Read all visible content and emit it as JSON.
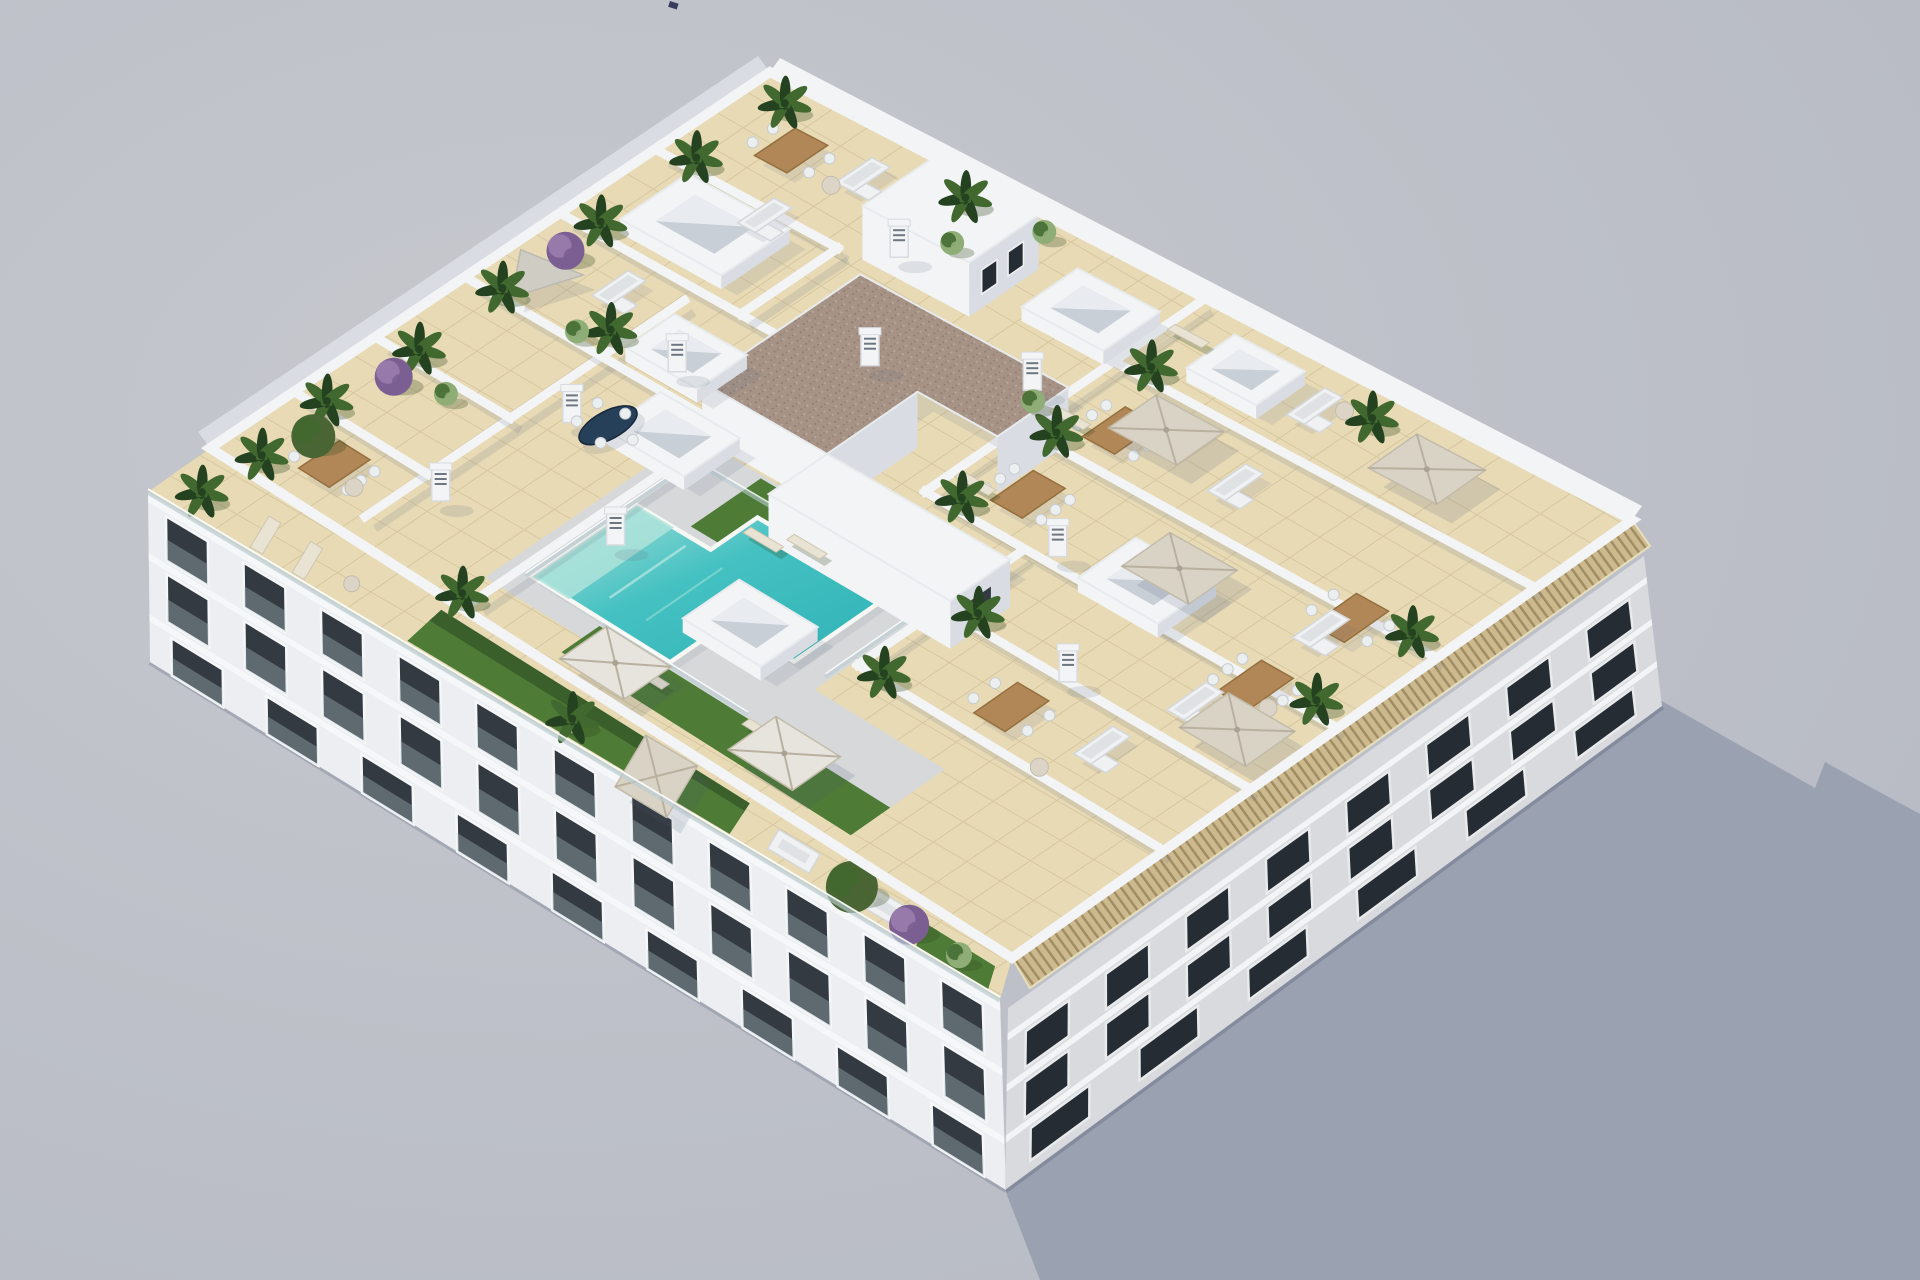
{
  "meta": {
    "title": "Aerial 3D architectural render of a white apartment building rooftop with communal pool deck, private terraces, parasols and plants",
    "type": "3d-architectural-visualization",
    "view": "high-angle axonometric aerial"
  },
  "colors": {
    "bg_hi": "#c6c8ce",
    "bg_lo": "#b4b8c2",
    "shadow": "#9aa1b1",
    "wall_white": "#f3f4f6",
    "wall_shade": "#d9dde3",
    "deck_tile": "#e7dab5",
    "deck_grout": "#d5c59d",
    "pool_main": "#45c1c2",
    "pool_deep": "#2fb2b5",
    "pool_ledge": "#aee3da",
    "pool_rim": "#f7f7f4",
    "surround": "#d6d8da",
    "turf": "#4e7c36",
    "hedge": "#3a5f2b",
    "gravel": "#a79386",
    "gravel_dot": "#8d7a70",
    "gravel_dot2": "#b7a69b",
    "wood": "#b28757",
    "wood_dark": "#94703f",
    "parasol": "#d9d3c5",
    "parasol_white": "#e6e4dc",
    "sail": "#cfccc4",
    "navy_table": "#274059",
    "chair_white": "#eceff0",
    "sofa_white": "#f0f1f2",
    "cushion": "#dfe2e5",
    "lounger": "#e9e3d4",
    "plant_mid": "#41692f",
    "palm_dark": "#24421f",
    "olive": "#4a6534",
    "pale_bush": "#8fae77",
    "purple": "#7b5f93",
    "lilac": "#9c7fae",
    "pot_tan": "#b59a77",
    "glass": "#b9cdd2",
    "chimney_slat": "#6e7680",
    "facade_left": "#eceef1",
    "facade_right": "#d8dade",
    "window_dark": "#343a41",
    "window_dark2": "#262c33",
    "window_frame": "#f6f7f8",
    "window_frame2": "#e8eaec",
    "pergola_tan": "#cdb98e",
    "pergola_line": "#a08c62",
    "sky_well": "#c9cfd7",
    "sky_well_light": "#e8ebef"
  },
  "scene": {
    "canvas": {
      "w": 1920,
      "h": 1280
    },
    "roof_quad": {
      "L": [
        210,
        448
      ],
      "T": [
        770,
        72
      ],
      "R": [
        1632,
        520
      ],
      "B": [
        1012,
        958
      ]
    },
    "band": {
      "outer": [
        [
          148,
          492
        ],
        [
          1000,
          1000
        ]
      ],
      "inner": [
        [
          210,
          448
        ],
        [
          1012,
          958
        ]
      ]
    },
    "facade_left": {
      "top": [
        [
          148,
          492
        ],
        [
          1000,
          1000
        ]
      ],
      "base": [
        [
          150,
          662
        ],
        [
          1006,
          1190
        ]
      ],
      "rows": [
        {
          "f0": 0.08,
          "f1": 0.34,
          "n": 11
        },
        {
          "f0": 0.42,
          "f1": 0.7,
          "n": 11
        },
        {
          "f0": 0.78,
          "f1": 1.0,
          "n": 9
        }
      ]
    },
    "facade_right": {
      "top": [
        [
          1008,
          1008
        ],
        [
          1644,
          556
        ]
      ],
      "base": [
        [
          1005,
          1190
        ],
        [
          1662,
          706
        ]
      ],
      "rows": [
        {
          "f0": 0.2,
          "f1": 0.4,
          "n": 8
        },
        {
          "f0": 0.48,
          "f1": 0.68,
          "n": 8
        },
        {
          "f0": 0.76,
          "f1": 0.94,
          "n": 6
        }
      ]
    },
    "pergola": {
      "quad": [
        [
          1012,
          958
        ],
        [
          1632,
          520
        ],
        [
          1650,
          546
        ],
        [
          1030,
          988
        ]
      ]
    },
    "shadow": [
      [
        1005,
        1190
      ],
      [
        1660,
        700
      ],
      [
        1815,
        788
      ],
      [
        1825,
        762
      ],
      [
        1872,
        788
      ],
      [
        1920,
        814
      ],
      [
        1920,
        1280
      ],
      [
        1040,
        1280
      ]
    ],
    "speck": {
      "x": 670,
      "y": 1,
      "w": 9,
      "h": 6
    },
    "surround": [
      [
        0.06,
        0.3
      ],
      [
        0.42,
        0.3
      ],
      [
        0.42,
        0.62
      ],
      [
        0.18,
        0.62
      ],
      [
        0.18,
        0.78
      ],
      [
        0.06,
        0.78
      ]
    ],
    "pool": {
      "outline": [
        [
          0.1,
          0.33
        ],
        [
          0.28,
          0.33
        ],
        [
          0.28,
          0.42
        ],
        [
          0.36,
          0.42
        ],
        [
          0.36,
          0.58
        ],
        [
          0.2,
          0.58
        ],
        [
          0.2,
          0.5
        ],
        [
          0.1,
          0.5
        ]
      ],
      "ledge": [
        [
          0.1,
          0.33
        ],
        [
          0.28,
          0.33
        ],
        [
          0.28,
          0.375
        ],
        [
          0.1,
          0.375
        ]
      ]
    },
    "turf": [
      [
        [
          0.295,
          0.385
        ],
        [
          0.415,
          0.385
        ],
        [
          0.415,
          0.53
        ],
        [
          0.295,
          0.53
        ]
      ],
      [
        [
          0.025,
          0.42
        ],
        [
          0.09,
          0.42
        ],
        [
          0.09,
          0.78
        ],
        [
          0.025,
          0.78
        ]
      ]
    ],
    "walls": [
      [
        0.04,
        0.165,
        0.6,
        0.165
      ],
      [
        0.15,
        0.005,
        0.15,
        0.165
      ],
      [
        0.295,
        0.005,
        0.295,
        0.165
      ],
      [
        0.455,
        0.005,
        0.455,
        0.315
      ],
      [
        0.625,
        0.005,
        0.625,
        0.315
      ],
      [
        0.795,
        0.005,
        0.795,
        0.215
      ],
      [
        0.625,
        0.215,
        0.795,
        0.215
      ],
      [
        0.02,
        0.315,
        0.375,
        0.315
      ],
      [
        0.375,
        0.235,
        0.375,
        0.315
      ],
      [
        0.525,
        0.505,
        0.995,
        0.505
      ],
      [
        0.525,
        0.505,
        0.525,
        0.995
      ],
      [
        0.685,
        0.505,
        0.685,
        0.995
      ],
      [
        0.845,
        0.505,
        0.845,
        0.995
      ],
      [
        0.245,
        0.625,
        0.52,
        0.625
      ],
      [
        0.245,
        0.625,
        0.245,
        0.995
      ],
      [
        0.385,
        0.625,
        0.385,
        0.995
      ]
    ],
    "fences": [
      [
        [
          0.095,
          0.325
        ],
        [
          0.385,
          0.325
        ],
        [
          0.385,
          0.6
        ]
      ],
      [
        [
          0.205,
          0.615
        ],
        [
          0.385,
          0.615
        ]
      ],
      [
        [
          0.095,
          0.42
        ],
        [
          0.095,
          0.6
        ]
      ]
    ],
    "core": {
      "gravel": [
        [
          0.5,
          0.255
        ],
        [
          0.775,
          0.255
        ],
        [
          0.775,
          0.5
        ],
        [
          0.655,
          0.5
        ],
        [
          0.655,
          0.405
        ],
        [
          0.5,
          0.405
        ]
      ],
      "h": 56
    },
    "wing": {
      "poly": [
        [
          0.4,
          0.405
        ],
        [
          0.5,
          0.405
        ],
        [
          0.5,
          0.625
        ],
        [
          0.4,
          0.625
        ]
      ],
      "h": 48
    },
    "bulkhead": {
      "poly": [
        [
          0.875,
          0.19
        ],
        [
          0.995,
          0.19
        ],
        [
          0.995,
          0.315
        ],
        [
          0.875,
          0.315
        ]
      ],
      "h": 54
    },
    "skylights": [
      {
        "a": 0.725,
        "b": 0.105,
        "s": 1.25
      },
      {
        "a": 0.405,
        "b": 0.285,
        "s": 1
      },
      {
        "a": 0.53,
        "b": 0.215,
        "s": 0.9
      },
      {
        "a": 0.215,
        "b": 0.515,
        "s": 1
      },
      {
        "a": 0.9,
        "b": 0.44,
        "s": 1
      },
      {
        "a": 0.575,
        "b": 0.735,
        "s": 1
      },
      {
        "a": 0.93,
        "b": 0.6,
        "s": 0.85
      }
    ],
    "chimneys": [
      [
        0.345,
        0.205
      ],
      [
        0.5,
        0.225
      ],
      [
        0.215,
        0.35
      ],
      [
        0.66,
        0.345
      ],
      [
        0.545,
        0.65
      ],
      [
        0.835,
        0.26
      ],
      [
        0.39,
        0.775
      ],
      [
        0.13,
        0.195
      ],
      [
        0.75,
        0.475
      ]
    ],
    "parasols": [
      {
        "a": 0.615,
        "b": 0.745,
        "c": "parasol"
      },
      {
        "a": 0.79,
        "b": 0.605,
        "c": "parasol"
      },
      {
        "a": 0.925,
        "b": 0.815,
        "c": "parasol"
      },
      {
        "a": 0.45,
        "b": 0.935,
        "c": "parasol"
      },
      {
        "a": 0.055,
        "b": 0.465,
        "c": "parasol_white"
      },
      {
        "a": 0.075,
        "b": 0.66,
        "c": "parasol_white"
      }
    ],
    "sail": {
      "a": 0.52,
      "b": 0.045
    },
    "tables": [
      {
        "a": 0.085,
        "b": 0.095,
        "n": 6
      },
      {
        "a": 0.9,
        "b": 0.09,
        "n": 4
      },
      {
        "a": 0.6,
        "b": 0.575,
        "n": 6
      },
      {
        "a": 0.755,
        "b": 0.575,
        "n": 6
      },
      {
        "a": 0.52,
        "b": 0.905,
        "n": 6
      },
      {
        "a": 0.675,
        "b": 0.905,
        "n": 4
      },
      {
        "a": 0.31,
        "b": 0.765,
        "n": 4
      }
    ],
    "navy_table": {
      "a": 0.365,
      "b": 0.235
    },
    "sofas": [
      [
        0.92,
        0.165
      ],
      [
        0.785,
        0.14
      ],
      [
        0.565,
        0.115
      ],
      [
        0.93,
        0.685
      ],
      [
        0.77,
        0.705
      ],
      [
        0.64,
        0.9
      ],
      [
        0.33,
        0.865
      ],
      [
        0.455,
        0.885
      ]
    ],
    "loungers": [
      [
        0.335,
        0.445
      ],
      [
        0.36,
        0.48
      ],
      [
        0.575,
        0.53
      ],
      [
        0.735,
        0.53
      ],
      [
        0.935,
        0.53
      ],
      [
        0.065,
        0.5
      ],
      [
        0.085,
        0.625
      ]
    ],
    "round_tables": [
      [
        0.07,
        0.13
      ],
      [
        0.88,
        0.15
      ],
      [
        0.945,
        0.705
      ],
      [
        0.5,
        0.935
      ],
      [
        0.255,
        0.84
      ]
    ],
    "palms": [
      [
        0.035,
        0.04
      ],
      [
        0.165,
        0.03
      ],
      [
        0.315,
        0.04
      ],
      [
        0.47,
        0.035
      ],
      [
        0.5,
        0.145
      ],
      [
        0.645,
        0.035
      ],
      [
        0.815,
        0.035
      ],
      [
        0.965,
        0.04
      ],
      [
        0.965,
        0.25
      ],
      [
        0.545,
        0.535
      ],
      [
        0.705,
        0.535
      ],
      [
        0.865,
        0.535
      ],
      [
        0.545,
        0.96
      ],
      [
        0.7,
        0.96
      ],
      [
        0.255,
        0.65
      ],
      [
        0.405,
        0.655
      ],
      [
        0.955,
        0.73
      ],
      [
        0.02,
        0.3
      ]
    ],
    "bushes": [
      {
        "a": 0.255,
        "b": 0.05,
        "c": "purple"
      },
      {
        "a": 0.575,
        "b": 0.04,
        "c": "purple"
      },
      {
        "a": 0.105,
        "b": 0.055,
        "c": "olive"
      },
      {
        "a": 0.89,
        "b": 0.285,
        "c": "green"
      },
      {
        "a": 0.975,
        "b": 0.335,
        "c": "green"
      },
      {
        "a": 0.73,
        "b": 0.49,
        "c": "green"
      },
      {
        "a": 0.47,
        "b": 0.125,
        "c": "green"
      },
      {
        "a": 0.275,
        "b": 0.1,
        "c": "green"
      }
    ],
    "band_items": [
      {
        "t": "turf",
        "t1": 0.3,
        "t2": 0.56
      },
      {
        "t": "hedge",
        "t1": 0.3,
        "t2": 0.68
      },
      {
        "t": "turf",
        "t1": 0.56,
        "t2": 0.68
      },
      {
        "t": "turf",
        "t1": 0.9,
        "t2": 0.985
      },
      {
        "t": "lounger",
        "p": 0.115
      },
      {
        "t": "lounger",
        "p": 0.165
      },
      {
        "t": "rtable",
        "p": 0.215
      },
      {
        "t": "parasol",
        "p": 0.585
      },
      {
        "t": "sofa",
        "p": 0.745
      },
      {
        "t": "sofa",
        "p": 0.86
      },
      {
        "t": "palm",
        "p": 0.48
      },
      {
        "t": "palm",
        "p": 0.035
      },
      {
        "t": "olive",
        "p": 0.815
      },
      {
        "t": "purple",
        "p": 0.885
      },
      {
        "t": "bush",
        "p": 0.945
      }
    ]
  }
}
